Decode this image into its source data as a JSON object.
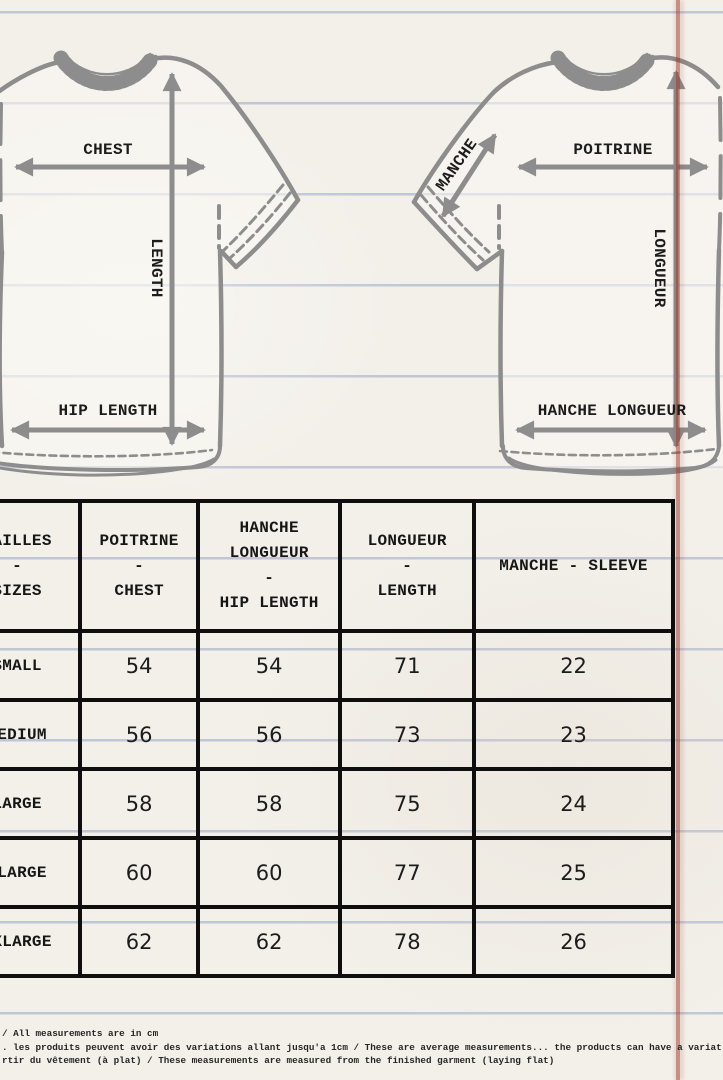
{
  "colors": {
    "paper": "#f3f0ea",
    "ruled_line": "#7c8db8",
    "margin_line": "#99372a",
    "outline_gray": "#8d8d8d",
    "ink": "#161616"
  },
  "diagram": {
    "front_shirt": {
      "chest": "CHEST",
      "length": "LENGTH",
      "hip": "HIP LENGTH"
    },
    "back_shirt": {
      "sleeve": "MANCHE",
      "chest": "POITRINE",
      "length": "LONGUEUR",
      "hip": "HANCHE LONGUEUR"
    }
  },
  "table": {
    "headers": {
      "sizes": [
        "TAILLES",
        "-",
        "SIZES"
      ],
      "chest": [
        "POITRINE",
        "-",
        "CHEST"
      ],
      "hip": [
        "HANCHE",
        "LONGUEUR",
        "-",
        "HIP LENGTH"
      ],
      "length": [
        "LONGUEUR",
        "-",
        "LENGTH"
      ],
      "sleeve": [
        "MANCHE - SLEEVE"
      ]
    },
    "rows": [
      {
        "size": "SMALL",
        "chest": "54",
        "hip": "54",
        "length": "71",
        "sleeve": "22"
      },
      {
        "size": "MEDIUM",
        "chest": "56",
        "hip": "56",
        "length": "73",
        "sleeve": "23"
      },
      {
        "size": "LARGE",
        "chest": "58",
        "hip": "58",
        "length": "75",
        "sleeve": "24"
      },
      {
        "size": "XLARGE",
        "chest": "60",
        "hip": "60",
        "length": "77",
        "sleeve": "25"
      },
      {
        "size": "XXLARGE",
        "chest": "62",
        "hip": "62",
        "length": "78",
        "sleeve": "26"
      }
    ]
  },
  "footnotes": [
    "/ All measurements are in cm",
    ". les produits peuvent avoir des variations allant jusqu'a 1cm / These are average measurements... the products can have a variat",
    "rtir du vêtement (à plat) / These measurements are measured from the finished garment (laying flat)"
  ]
}
